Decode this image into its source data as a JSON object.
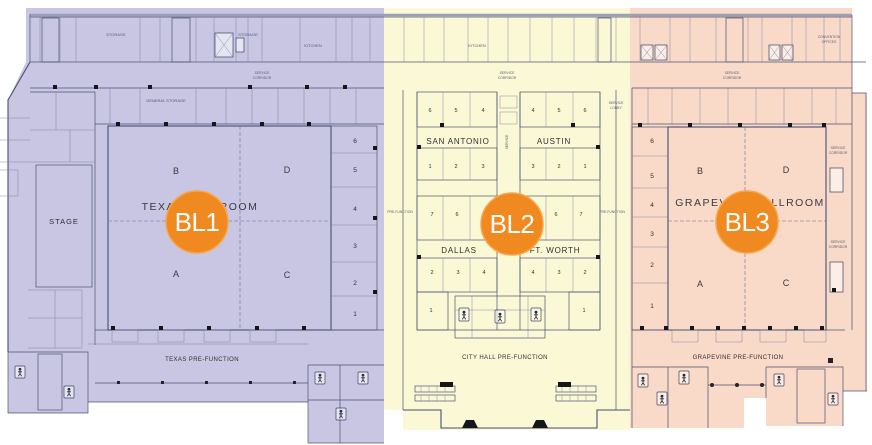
{
  "page": {
    "title": "Convention center level floor plan with three ballroom zones"
  },
  "colors": {
    "zone_bl1": "#c8c6e2",
    "zone_bl2": "#fbf8d5",
    "zone_bl3": "#f9d9c7",
    "badge": "#f0891f",
    "badge_ring": "#f7a74e",
    "line": "#4d5472"
  },
  "badges": [
    {
      "id": "bl1",
      "label": "BL1"
    },
    {
      "id": "bl2",
      "label": "BL2"
    },
    {
      "id": "bl3",
      "label": "BL3"
    }
  ],
  "bl1": {
    "ballroom_name": "TEXAS BALLROOM",
    "stage": "STAGE",
    "prefunction": "TEXAS PRE-FUNCTION",
    "sections": [
      "B",
      "D",
      "A",
      "C"
    ],
    "rooms": [
      "6",
      "5",
      "4",
      "3",
      "2",
      "1"
    ]
  },
  "bl2": {
    "san_antonio": "SAN ANTONIO",
    "austin": "AUSTIN",
    "dallas": "DALLAS",
    "ft_worth": "FT. WORTH",
    "prefunction": "CITY HALL PRE-FUNCTION",
    "top_left": [
      "6",
      "5",
      "4"
    ],
    "top_right": [
      "4",
      "5",
      "6"
    ],
    "mid_left": [
      "1",
      "2",
      "3"
    ],
    "mid_right": [
      "3",
      "2",
      "1"
    ],
    "row3_left": [
      "7",
      "6"
    ],
    "row3_right": [
      "6",
      "7"
    ],
    "dallas_row": [
      "2",
      "3",
      "4"
    ],
    "ftworth_row": [
      "4",
      "3",
      "2"
    ],
    "corner_left": "1",
    "corner_right": "1"
  },
  "bl3": {
    "ballroom_name": "GRAPEVINE BALLROOM",
    "prefunction": "GRAPEVINE PRE-FUNCTION",
    "sections": [
      "B",
      "D",
      "A",
      "C"
    ],
    "rooms": [
      "6",
      "5",
      "4",
      "3",
      "2",
      "1"
    ]
  },
  "misc": {
    "storage": "STORAGE",
    "kitchen": "KITCHEN",
    "general_storage": "GENERAL STORAGE",
    "sc1": "SERVICE",
    "sc2": "CORRIDOR",
    "sl1": "SERVICE",
    "sl2": "LOBBY",
    "prefunction_side": "PRE-FUNCTION",
    "offices1": "CONVENTION",
    "offices2": "OFFICES"
  }
}
